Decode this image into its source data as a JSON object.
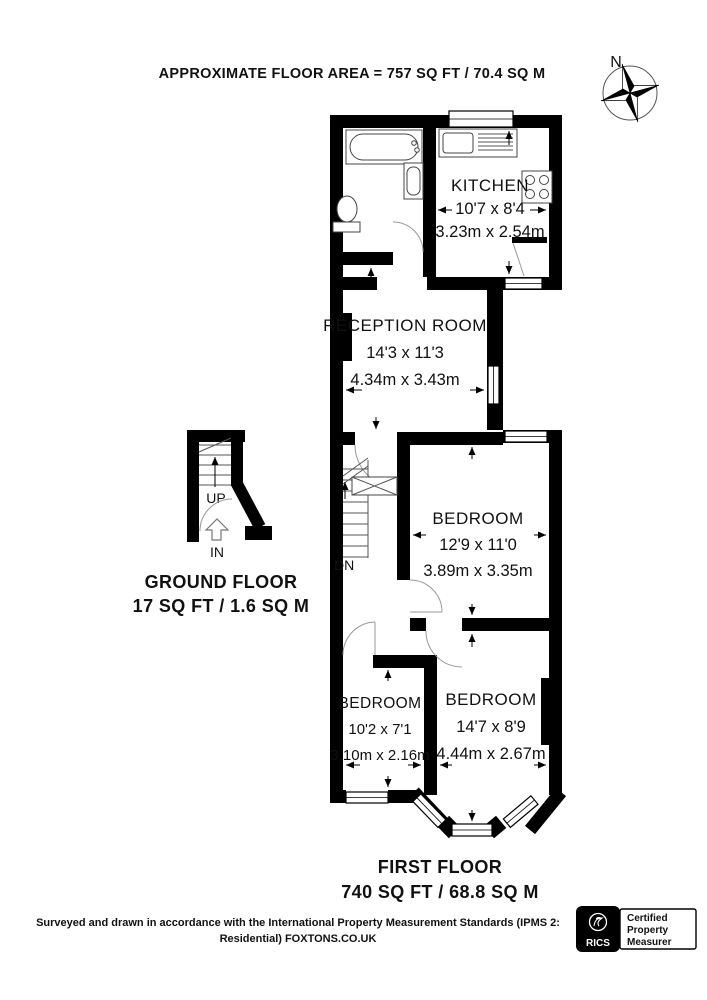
{
  "title": "APPROXIMATE FLOOR AREA = 757 SQ FT / 70.4 SQ M",
  "compass": {
    "north_label": "N"
  },
  "rooms": {
    "kitchen": {
      "name": "KITCHEN",
      "imperial": "10'7 x 8'4",
      "metric": "3.23m x 2.54m"
    },
    "reception": {
      "name": "RECEPTION ROOM",
      "imperial": "14'3 x 11'3",
      "metric": "4.34m x 3.43m"
    },
    "bedroom_middle": {
      "name": "BEDROOM",
      "imperial": "12'9 x 11'0",
      "metric": "3.89m x 3.35m"
    },
    "bedroom_left": {
      "name": "BEDROOM",
      "imperial": "10'2 x 7'1",
      "metric": "3.10m x 2.16m"
    },
    "bedroom_right": {
      "name": "BEDROOM",
      "imperial": "14'7 x 8'9",
      "metric": "4.44m x 2.67m"
    }
  },
  "stairs": {
    "up": "UP",
    "down": "DN",
    "in": "IN"
  },
  "ground_floor": {
    "title": "GROUND FLOOR",
    "area": "17 SQ FT / 1.6 SQ M"
  },
  "first_floor": {
    "title": "FIRST FLOOR",
    "area": "740 SQ FT / 68.8 SQ M"
  },
  "footer": {
    "line1": "Surveyed and drawn in accordance with the International Property Measurement Standards (IPMS 2:",
    "line2": "Residential) FOXTONS.CO.UK"
  },
  "badge": {
    "brand": "RICS",
    "lines": [
      "Certified",
      "Property",
      "Measurer"
    ]
  },
  "colors": {
    "wall": "#000000",
    "background": "#ffffff"
  }
}
